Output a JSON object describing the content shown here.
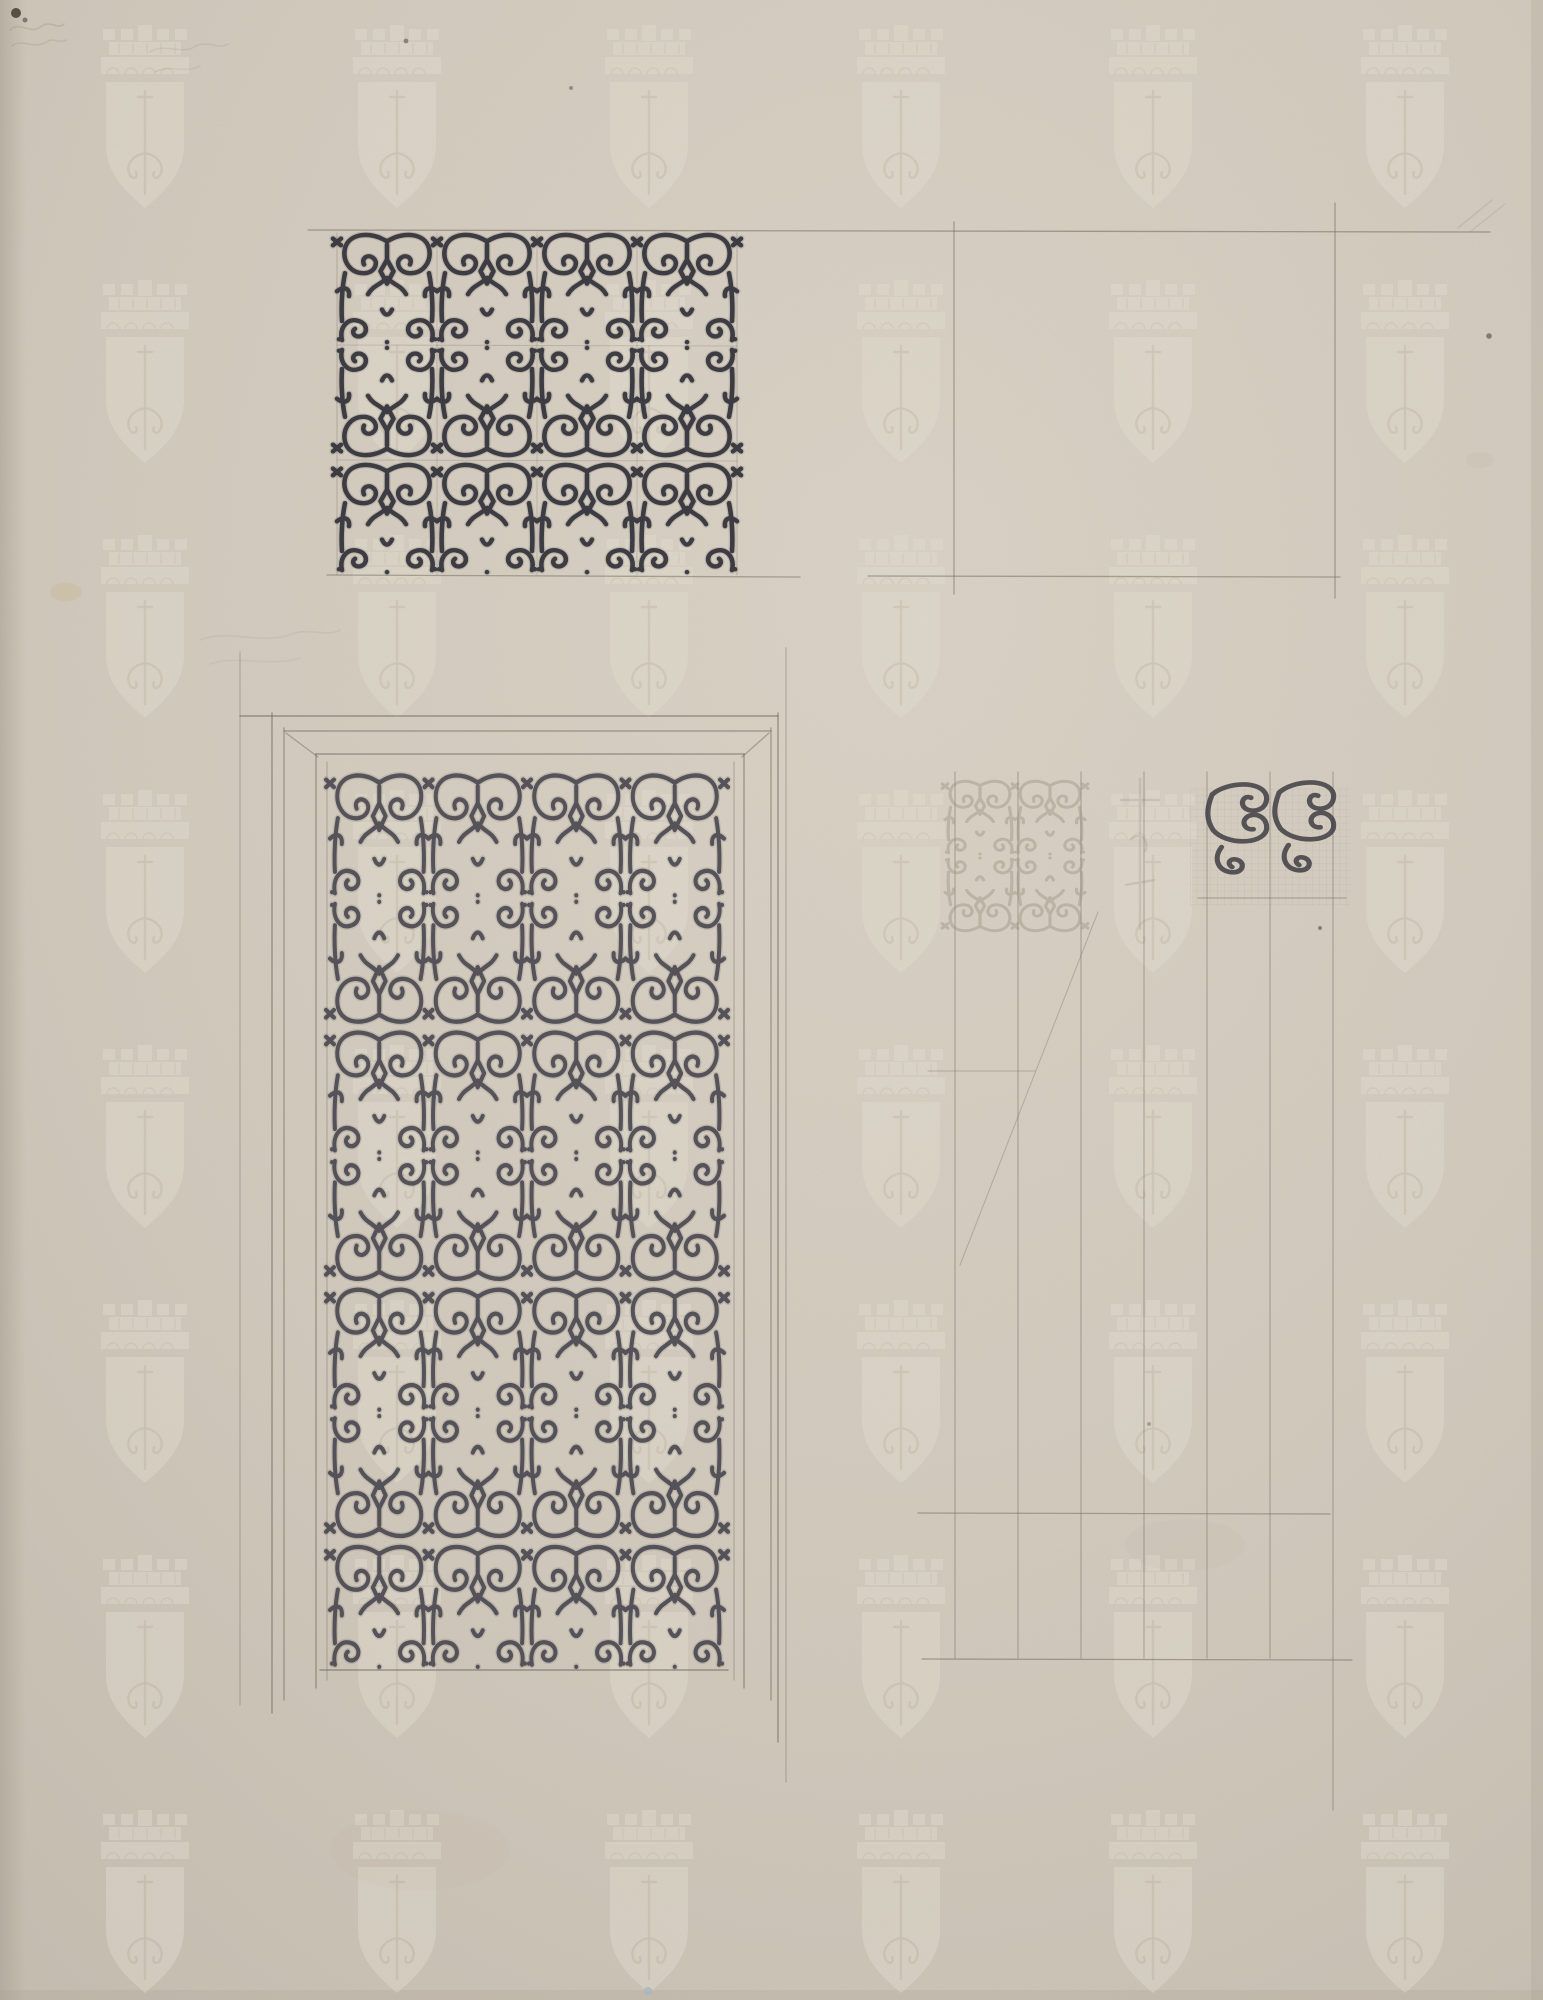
{
  "artwork": {
    "title": "Design drawing of ornamental scrollwork grille panels for a door",
    "medium": "Pencil and ink on cream laid paper with repeating crowned-shield watermark",
    "visible_text": []
  },
  "palette": {
    "paper_base": "#d0c8bb",
    "paper_light": "#d8d1c4",
    "paper_dark": "#c3bbae",
    "paper_edge": "#a89f92",
    "pencil": "#6f675a",
    "pencil_faint": "#968e80",
    "ink": "#34333b",
    "ink_soft": "#4a4850",
    "watermark_light": "#e2ddd0",
    "watermark_line": "#c6beae",
    "stain": "#c2ab74",
    "speck_dark": "#3f3a31",
    "speck_blue": "#aab5c4"
  },
  "watermark": {
    "name": "crowned-shield-with-sword",
    "columns": [
      145,
      397,
      649,
      901,
      1153,
      1405
    ],
    "row_tops": [
      25,
      280,
      535,
      790,
      1045,
      1300,
      1555,
      1810
    ],
    "opacity": 0.5
  },
  "guide_lines": [
    {
      "x1": 308,
      "y1": 230,
      "x2": 1490,
      "y2": 232,
      "o": 0.55
    },
    {
      "x1": 327,
      "y1": 575,
      "x2": 800,
      "y2": 577,
      "o": 0.5
    },
    {
      "x1": 868,
      "y1": 576,
      "x2": 1340,
      "y2": 577,
      "o": 0.5
    },
    {
      "x1": 954,
      "y1": 222,
      "x2": 954,
      "y2": 594,
      "o": 0.5
    },
    {
      "x1": 1335,
      "y1": 203,
      "x2": 1335,
      "y2": 598,
      "o": 0.5
    }
  ],
  "top_left_panel": {
    "x": 337,
    "y": 230,
    "w": 400,
    "h": 345,
    "rows": 3,
    "cols": 4,
    "inner_guides": [
      {
        "x1": 437,
        "y1": 233,
        "x2": 437,
        "y2": 575,
        "o": 0.22
      },
      {
        "x1": 537,
        "y1": 233,
        "x2": 537,
        "y2": 575,
        "o": 0.22
      },
      {
        "x1": 637,
        "y1": 233,
        "x2": 637,
        "y2": 575,
        "o": 0.22
      },
      {
        "x1": 337,
        "y1": 345,
        "x2": 737,
        "y2": 346,
        "o": 0.25
      },
      {
        "x1": 337,
        "y1": 460,
        "x2": 737,
        "y2": 461,
        "o": 0.25
      },
      {
        "x1": 337,
        "y1": 233,
        "x2": 337,
        "y2": 575,
        "o": 0.3
      },
      {
        "x1": 737,
        "y1": 233,
        "x2": 737,
        "y2": 575,
        "o": 0.3
      }
    ]
  },
  "top_right_rect": {
    "left": 954,
    "right": 1335,
    "top": 231,
    "bottom": 576
  },
  "door": {
    "frame_lines": [
      {
        "x1": 240,
        "y1": 652,
        "x2": 240,
        "y2": 1705,
        "o": 0.3
      },
      {
        "x1": 272,
        "y1": 713,
        "x2": 272,
        "y2": 1713,
        "o": 0.6
      },
      {
        "x1": 284,
        "y1": 728,
        "x2": 284,
        "y2": 1700,
        "o": 0.5
      },
      {
        "x1": 771,
        "y1": 728,
        "x2": 771,
        "y2": 1700,
        "o": 0.5
      },
      {
        "x1": 778,
        "y1": 713,
        "x2": 778,
        "y2": 1742,
        "o": 0.6
      },
      {
        "x1": 786,
        "y1": 648,
        "x2": 786,
        "y2": 1782,
        "o": 0.3
      },
      {
        "x1": 240,
        "y1": 716,
        "x2": 778,
        "y2": 716,
        "o": 0.6
      },
      {
        "x1": 284,
        "y1": 731,
        "x2": 771,
        "y2": 731,
        "o": 0.5
      },
      {
        "x1": 316,
        "y1": 754,
        "x2": 744,
        "y2": 754,
        "o": 0.55
      },
      {
        "x1": 316,
        "y1": 754,
        "x2": 316,
        "y2": 1688,
        "o": 0.55
      },
      {
        "x1": 744,
        "y1": 754,
        "x2": 744,
        "y2": 1688,
        "o": 0.55
      },
      {
        "x1": 327,
        "y1": 762,
        "x2": 327,
        "y2": 1680,
        "o": 0.3
      },
      {
        "x1": 734,
        "y1": 762,
        "x2": 734,
        "y2": 1680,
        "o": 0.3
      },
      {
        "x1": 286,
        "y1": 733,
        "x2": 318,
        "y2": 757,
        "o": 0.45
      },
      {
        "x1": 769,
        "y1": 733,
        "x2": 742,
        "y2": 757,
        "o": 0.45
      },
      {
        "x1": 320,
        "y1": 1670,
        "x2": 728,
        "y2": 1670,
        "o": 0.6
      }
    ],
    "panel": {
      "x": 330,
      "y": 770,
      "w": 394,
      "h": 900,
      "rows": 7,
      "cols": 4
    }
  },
  "study": {
    "verticals": [
      955,
      1018,
      1081,
      1144,
      1207,
      1270,
      1333
    ],
    "v_top": 772,
    "v_bottom": 1658,
    "long_vertical": {
      "x": 1333,
      "y1": 772,
      "y2": 1810
    },
    "horizontals": [
      {
        "x1": 1198,
        "y1": 898,
        "x2": 1346,
        "y2": 898,
        "o": 0.4
      },
      {
        "x1": 928,
        "y1": 1071,
        "x2": 1035,
        "y2": 1071,
        "o": 0.28
      },
      {
        "x1": 918,
        "y1": 1513,
        "x2": 1330,
        "y2": 1514,
        "o": 0.5
      },
      {
        "x1": 922,
        "y1": 1659,
        "x2": 1352,
        "y2": 1660,
        "o": 0.55
      }
    ],
    "diagonal": {
      "x1": 1098,
      "y1": 912,
      "x2": 960,
      "y2": 1265,
      "o": 0.32
    },
    "fine_grid": {
      "x": 1190,
      "y": 788,
      "w": 160,
      "h": 118,
      "step": 6.8,
      "o": 0.35
    },
    "left_cluster": {
      "x": 945,
      "y": 778,
      "cols": 2,
      "rows": 2,
      "unit_w": 70,
      "unit_h": 78,
      "o": 0.4
    },
    "mid_cluster": {
      "o": 0.26
    },
    "right_cluster": {
      "x": 1205,
      "y": 782,
      "spacing": 67,
      "o": 0.8
    }
  },
  "marks": {
    "specks": [
      {
        "x": 16,
        "y": 13,
        "r": 5,
        "c": "#3f3a31",
        "o": 0.85
      },
      {
        "x": 25,
        "y": 20,
        "r": 2.5,
        "c": "#3f3a31",
        "o": 0.55
      },
      {
        "x": 406,
        "y": 41,
        "r": 2.4,
        "c": "#555046",
        "o": 0.6
      },
      {
        "x": 571,
        "y": 88,
        "r": 2,
        "c": "#555046",
        "o": 0.5
      },
      {
        "x": 1489,
        "y": 336,
        "r": 2.8,
        "c": "#4a463e",
        "o": 0.6
      },
      {
        "x": 1320,
        "y": 928,
        "r": 2,
        "c": "#4a463e",
        "o": 0.55
      },
      {
        "x": 1149,
        "y": 1424,
        "r": 2,
        "c": "#5a554b",
        "o": 0.4
      },
      {
        "x": 648,
        "y": 1991,
        "r": 4,
        "c": "#aab5c4",
        "o": 0.8
      }
    ],
    "scribbles": [
      {
        "d": "M10,30 C20,20 30,36 42,26 C50,20 58,30 64,24",
        "o": 0.3
      },
      {
        "d": "M12,46 C22,38 34,50 46,42 C54,37 60,44 66,40",
        "o": 0.25
      },
      {
        "d": "M150,52 C165,42 180,56 196,46 C208,40 218,50 228,44",
        "o": 0.2
      },
      {
        "d": "M155,72 C170,64 185,74 200,66",
        "o": 0.17
      },
      {
        "d": "M1458,228 L1492,200",
        "o": 0.25
      },
      {
        "d": "M1470,232 L1505,204",
        "o": 0.2
      },
      {
        "d": "M200,640 C230,628 260,646 292,634 C310,627 326,638 340,630",
        "o": 0.14
      },
      {
        "d": "M210,664 C240,654 268,668 300,658",
        "o": 0.12
      }
    ],
    "stains": [
      {
        "x": 66,
        "y": 592,
        "rx": 16,
        "ry": 9,
        "c": "#c2ab74",
        "o": 0.22
      },
      {
        "x": 1185,
        "y": 1545,
        "rx": 60,
        "ry": 26,
        "c": "#b7ab96",
        "o": 0.08
      },
      {
        "x": 420,
        "y": 1850,
        "rx": 90,
        "ry": 40,
        "c": "#b7ab96",
        "o": 0.06
      },
      {
        "x": 1480,
        "y": 460,
        "rx": 14,
        "ry": 8,
        "c": "#b7ab96",
        "o": 0.12
      }
    ]
  }
}
